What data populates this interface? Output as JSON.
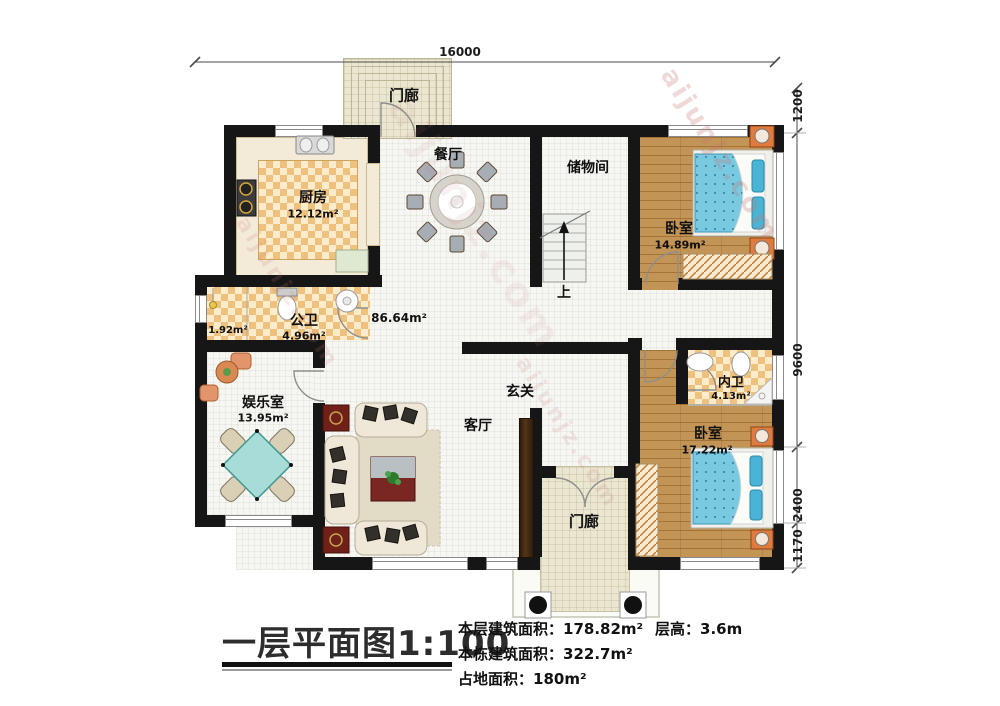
{
  "title": {
    "text": "一层平面图1:100"
  },
  "stats": {
    "floor_area_label": "本层建筑面积：",
    "floor_area_value": "178.82m²",
    "building_area_label": "本栋建筑面积：",
    "building_area_value": "322.7m²",
    "land_area_label": "占地面积：",
    "land_area_value": "180m²",
    "story_height_label": "层高：",
    "story_height_value": "3.6m"
  },
  "dimensions": {
    "top": "16000",
    "right_1": "1200",
    "right_2": "9600",
    "right_3": "2400",
    "right_4": "1170"
  },
  "rooms": {
    "porch_top": "门廊",
    "porch_bottom": "门廊",
    "kitchen_name": "厨房",
    "kitchen_area": "12.12m²",
    "dining_name": "餐厅",
    "storage_name": "储物间",
    "bedroom_top_name": "卧室",
    "bedroom_top_area": "14.89m²",
    "bath_public_name": "公卫",
    "bath_public_area": "4.96m²",
    "bath_public_area2": "1.92m²",
    "entertainment_name": "娱乐室",
    "entertainment_area": "13.95m²",
    "living_open_area": "86.64m²",
    "living_name": "客厅",
    "hall_name": "玄关",
    "bath_private_name": "内卫",
    "bath_private_area": "4.13m²",
    "bedroom_bottom_name": "卧室",
    "bedroom_bottom_area": "17.22m²",
    "stairs_up": "上"
  },
  "watermark": {
    "text": "aijunjz.com"
  },
  "colors": {
    "wall": "#161616",
    "floor_checker": "#eec27e",
    "wood_floor": "#b48244",
    "bed_blue": "#79c9e1",
    "table_teal": "#a8dcd8",
    "porch_floor": "#eae6cf",
    "accent_orange": "#e07a3e"
  }
}
